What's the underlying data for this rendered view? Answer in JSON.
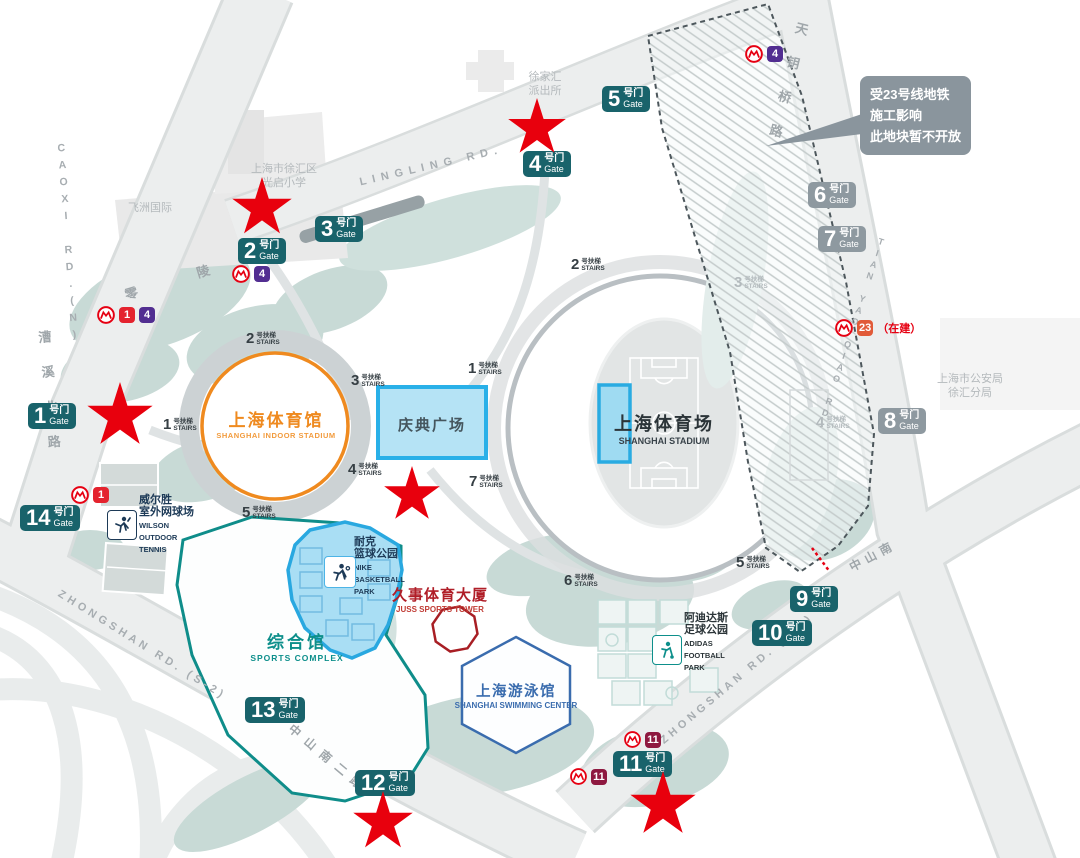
{
  "gates": [
    {
      "num": "1",
      "cn": "号门",
      "en": "Gate"
    },
    {
      "num": "2",
      "cn": "号门",
      "en": "Gate"
    },
    {
      "num": "3",
      "cn": "号门",
      "en": "Gate"
    },
    {
      "num": "4",
      "cn": "号门",
      "en": "Gate"
    },
    {
      "num": "5",
      "cn": "号门",
      "en": "Gate"
    },
    {
      "num": "6",
      "cn": "号门",
      "en": "Gate"
    },
    {
      "num": "7",
      "cn": "号门",
      "en": "Gate"
    },
    {
      "num": "8",
      "cn": "号门",
      "en": "Gate"
    },
    {
      "num": "9",
      "cn": "号门",
      "en": "Gate"
    },
    {
      "num": "10",
      "cn": "号门",
      "en": "Gate"
    },
    {
      "num": "11",
      "cn": "号门",
      "en": "Gate"
    },
    {
      "num": "12",
      "cn": "号门",
      "en": "Gate"
    },
    {
      "num": "13",
      "cn": "号门",
      "en": "Gate"
    },
    {
      "num": "14",
      "cn": "号门",
      "en": "Gate"
    }
  ],
  "stairs": {
    "cn": "号扶梯",
    "en": "STAIRS",
    "nums": [
      "2",
      "2",
      "3",
      "1",
      "1",
      "4",
      "7",
      "5",
      "6",
      "5",
      "3",
      "4"
    ]
  },
  "roads": {
    "caoxi_en": "CAOXI RD.(N)",
    "caoxi_cn": "漕溪北路",
    "lingling_en": "LINGLING RD.",
    "lingling_cn": "零陵路",
    "tianyao_cn": "天钥桥路",
    "tianyao_en": "TIAN YAO QIAO RD.",
    "zhongshan_left_en": "ZHONGSHAN RD. (S-2)",
    "zhongshan_left_cn": "中山南二路",
    "zhongshan_right_en": "ZHONGSHAN RD. (S-2)",
    "zhongshan_right_cn": "中山南"
  },
  "buildings": {
    "indoor": {
      "cn": "上海体育馆",
      "en": "SHANGHAI INDOOR STADIUM"
    },
    "stadium": {
      "cn": "上海体育场",
      "en": "SHANGHAI STADIUM"
    },
    "plaza": {
      "cn": "庆典广场"
    },
    "complex": {
      "cn": "综合馆",
      "en": "SPORTS COMPLEX"
    },
    "swimming": {
      "cn": "上海游泳馆",
      "en": "SHANGHAI SWIMMING CENTER"
    },
    "juss": {
      "cn": "久事体育大厦",
      "en": "JUSS SPORTS TOWER"
    },
    "nike": {
      "cn1": "耐克",
      "cn2": "篮球公园",
      "en1": "NIKE",
      "en2": "BASKETBALL",
      "en3": "PARK"
    },
    "wilson": {
      "cn1": "威尔胜",
      "cn2": "室外网球场",
      "en1": "WILSON",
      "en2": "OUTDOOR",
      "en3": "TENNIS"
    },
    "adidas": {
      "cn1": "阿迪达斯",
      "cn2": "足球公园",
      "en1": "ADIDAS",
      "en2": "FOOTBALL",
      "en3": "PARK"
    }
  },
  "landmarks": {
    "school1": "上海市徐汇区",
    "school2": "光启小学",
    "feizhou": "飞洲国际",
    "pcs1": "徐家汇",
    "pcs2": "派出所",
    "psb1": "上海市公安局",
    "psb2": "徐汇分局"
  },
  "callout": {
    "line1": "受23号线地铁",
    "line2": "施工影响",
    "line3": "此地块暂不开放"
  },
  "metro": {
    "line1": "1",
    "line4": "4",
    "line11": "11",
    "line23": "23",
    "construction": "（在建）"
  },
  "colors": {
    "gate_teal": "#19636b",
    "gate_gray": "#8e99a0",
    "star_red": "#e8000d",
    "line1": "#e4232e",
    "line4": "#522e91",
    "line11": "#8e1940",
    "line23": "#e15a38",
    "metro_red": "#e60012",
    "plaza_fill": "#b5e3f5",
    "plaza_border": "#29b0e8",
    "indoor_orange": "#ef8a1f",
    "complex_teal": "#0d8f8b",
    "swim_blue": "#3a6cae",
    "juss_red": "#b01e28"
  }
}
